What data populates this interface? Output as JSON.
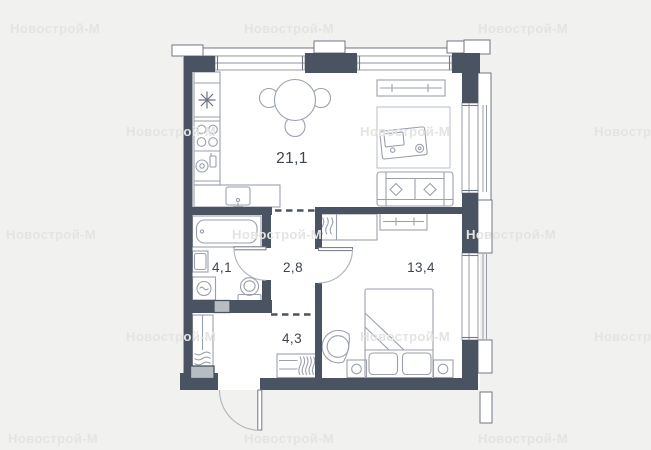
{
  "plan": {
    "rooms": [
      {
        "name": "living-kitchen",
        "area_label": "21,1"
      },
      {
        "name": "bathroom",
        "area_label": "4,1"
      },
      {
        "name": "hallway",
        "area_label": "2,8"
      },
      {
        "name": "bedroom",
        "area_label": "13,4"
      },
      {
        "name": "entry-hall",
        "area_label": "4,3"
      }
    ]
  },
  "watermark": {
    "text": "Новострой-М",
    "positions": [
      {
        "x": 10,
        "y": 33
      },
      {
        "x": 244,
        "y": 33
      },
      {
        "x": 478,
        "y": 33
      },
      {
        "x": 126,
        "y": 136
      },
      {
        "x": 360,
        "y": 136
      },
      {
        "x": 594,
        "y": 136
      },
      {
        "x": 6,
        "y": 239
      },
      {
        "x": 232,
        "y": 239
      },
      {
        "x": 466,
        "y": 239
      },
      {
        "x": 126,
        "y": 341
      },
      {
        "x": 360,
        "y": 341
      },
      {
        "x": 594,
        "y": 341
      },
      {
        "x": 8,
        "y": 443
      },
      {
        "x": 244,
        "y": 443
      },
      {
        "x": 478,
        "y": 443
      }
    ]
  },
  "colors": {
    "background": "#f1f1ef",
    "wall": "#4a5361",
    "floor": "#ffffff",
    "furniture_line": "#9aa1ac",
    "facade_line": "#707785",
    "label": "#3e4450",
    "watermark": "#e4e4e2",
    "shaft": "#b8bcc3"
  }
}
